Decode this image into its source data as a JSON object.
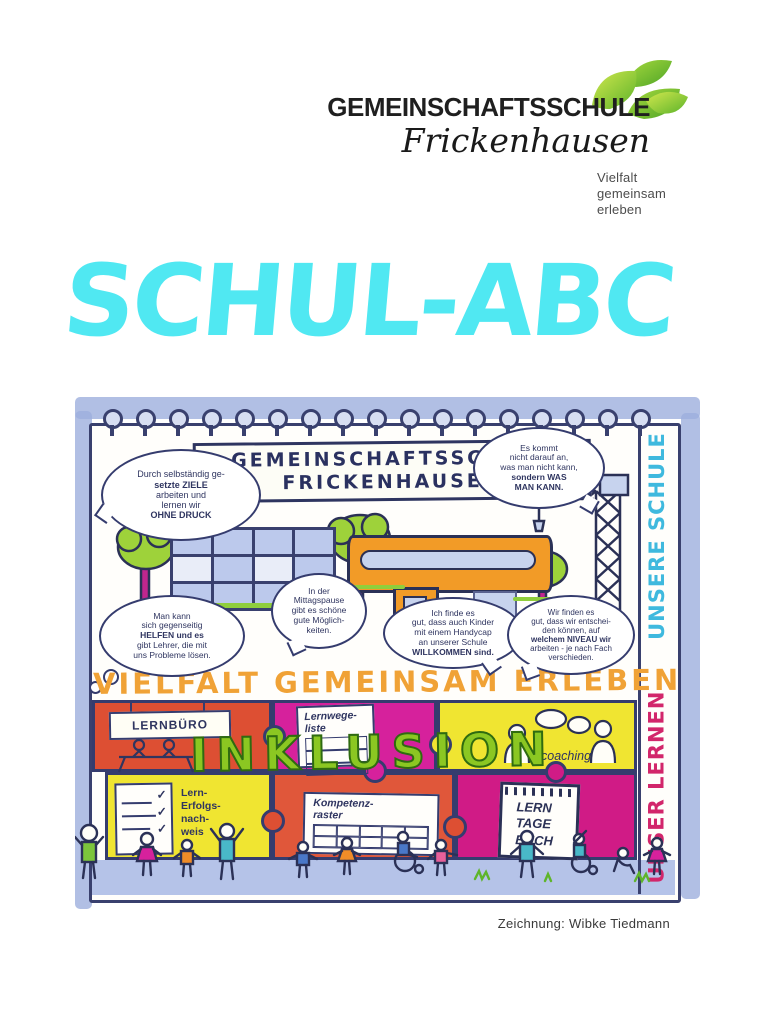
{
  "logo": {
    "name": "GEMEINSCHAFTSSCHULE",
    "place": "Frickenhausen",
    "tagline": [
      "Vielfalt",
      "gemeinsam",
      "erleben"
    ]
  },
  "title": "SCHUL-ABC",
  "credit": "Zeichnung: Wibke Tiedmann",
  "drawing": {
    "banner": [
      "GEMEINSCHAFTSSCHULE",
      "FRICKENHAUSEN"
    ],
    "slogan": "VIELFALT GEMEINSAM ERLEBEN",
    "inklusion": "INKLUSION",
    "side": {
      "top": "UNSERE SCHULE",
      "bottom": "UNSER LERNEN"
    },
    "bubbles": {
      "b1": [
        "Durch selbständig ge-",
        "setzte ZIELE",
        "arbeiten und",
        "lernen wir",
        "OHNE DRUCK"
      ],
      "b2": [
        "Es kommt",
        "nicht darauf an,",
        "was man nicht kann,",
        "sondern WAS",
        "MAN KANN."
      ],
      "b3": [
        "Man kann",
        "sich gegenseitig",
        "HELFEN und es",
        "gibt Lehrer, die mit",
        "uns Probleme lösen."
      ],
      "b4": [
        "In der",
        "Mittagspause",
        "gibt es schöne",
        "gute Möglich-",
        "keiten."
      ],
      "b5": [
        "Ich finde es",
        "gut, dass auch Kinder",
        "mit einem Handycap",
        "an unserer Schule",
        "WILLKOMMEN sind."
      ],
      "b6": [
        "Wir finden es",
        "gut, dass wir entschei-",
        "den können, auf",
        "welchem NIVEAU wir",
        "arbeiten - je nach Fach",
        "verschieden."
      ]
    },
    "puzzle": {
      "lernbuero": "LERNBÜRO",
      "lernwege": [
        "Lernwege-",
        "liste"
      ],
      "coaching": "coaching",
      "erfolg": [
        "Lern-",
        "Erfolgs-",
        "nach-",
        "weis"
      ],
      "kompetenz": [
        "Kompetenz-",
        "raster"
      ],
      "buch": [
        "LERN",
        "TAGE",
        "BUCH"
      ]
    },
    "colors": {
      "title_cyan": "#50e8f2",
      "slogan_orange": "#f0a236",
      "inklusion_green": "#8bc722",
      "puzzle_red": "#dd4f33",
      "puzzle_magenta": "#d6219c",
      "puzzle_yellow": "#f0e531",
      "side_top_cyan": "#3fb9de",
      "side_bottom_pink": "#d2266b"
    }
  }
}
